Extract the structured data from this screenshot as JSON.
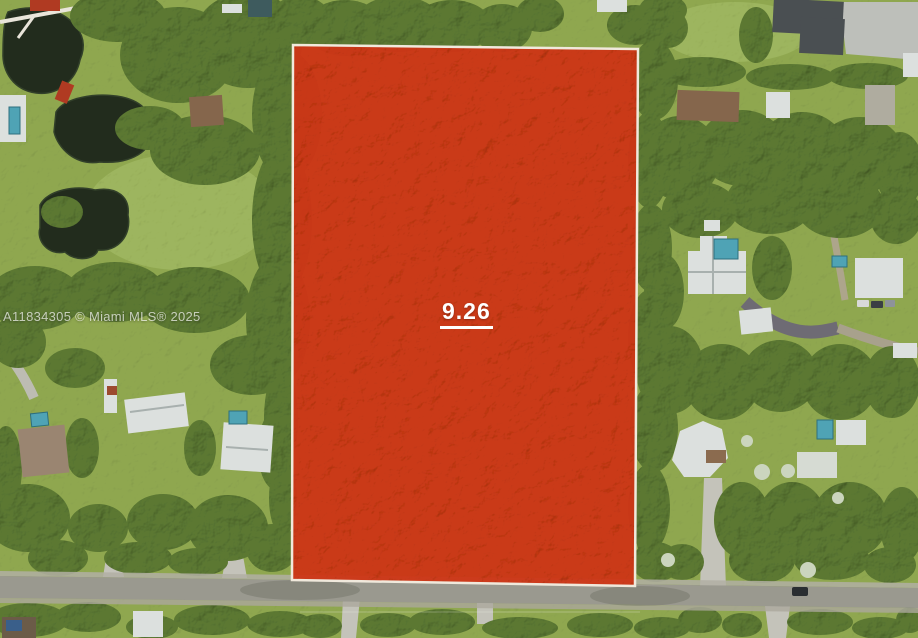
{
  "watermark": {
    "text": "A11834305 © Miami MLS® 2025",
    "color": "#FFFFFF"
  },
  "parcel": {
    "label": "9.26",
    "label_color": "#FFFFFF",
    "fill_color": "#CE3513",
    "border_color": "#F0E9DC"
  },
  "palette": {
    "grass": "#8FA750",
    "meadow": "#9DB55E",
    "trees": "#5B7833",
    "water": "#222C1D",
    "road": "#9A998F",
    "concrete": "#C4C3BA",
    "roof_white": "#DCE0DE",
    "roof_dark": "#4A4F52",
    "roof_brown": "#85664C",
    "pool_teal": "#4FA3B5",
    "bridge_red": "#B03A22"
  }
}
